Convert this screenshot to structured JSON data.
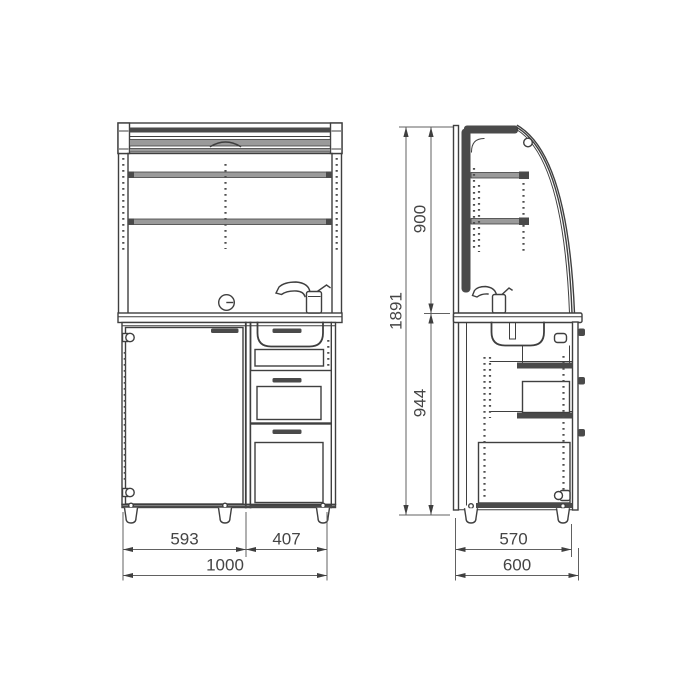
{
  "meta": {
    "type": "technical-drawing",
    "subject": "kitchen cabinet with roller shutter, two orthographic views"
  },
  "front_view": {
    "width_left": "593",
    "width_right": "407",
    "width_total": "1000"
  },
  "side_view": {
    "height_upper": "900",
    "height_lower": "944",
    "height_total": "1891",
    "depth_inner": "570",
    "depth_total": "600"
  },
  "colors": {
    "line": "#3f3f3f",
    "dark_fill": "#4a4a4a",
    "dimension_line": "#616161",
    "text": "#454545",
    "background": "#ffffff"
  }
}
